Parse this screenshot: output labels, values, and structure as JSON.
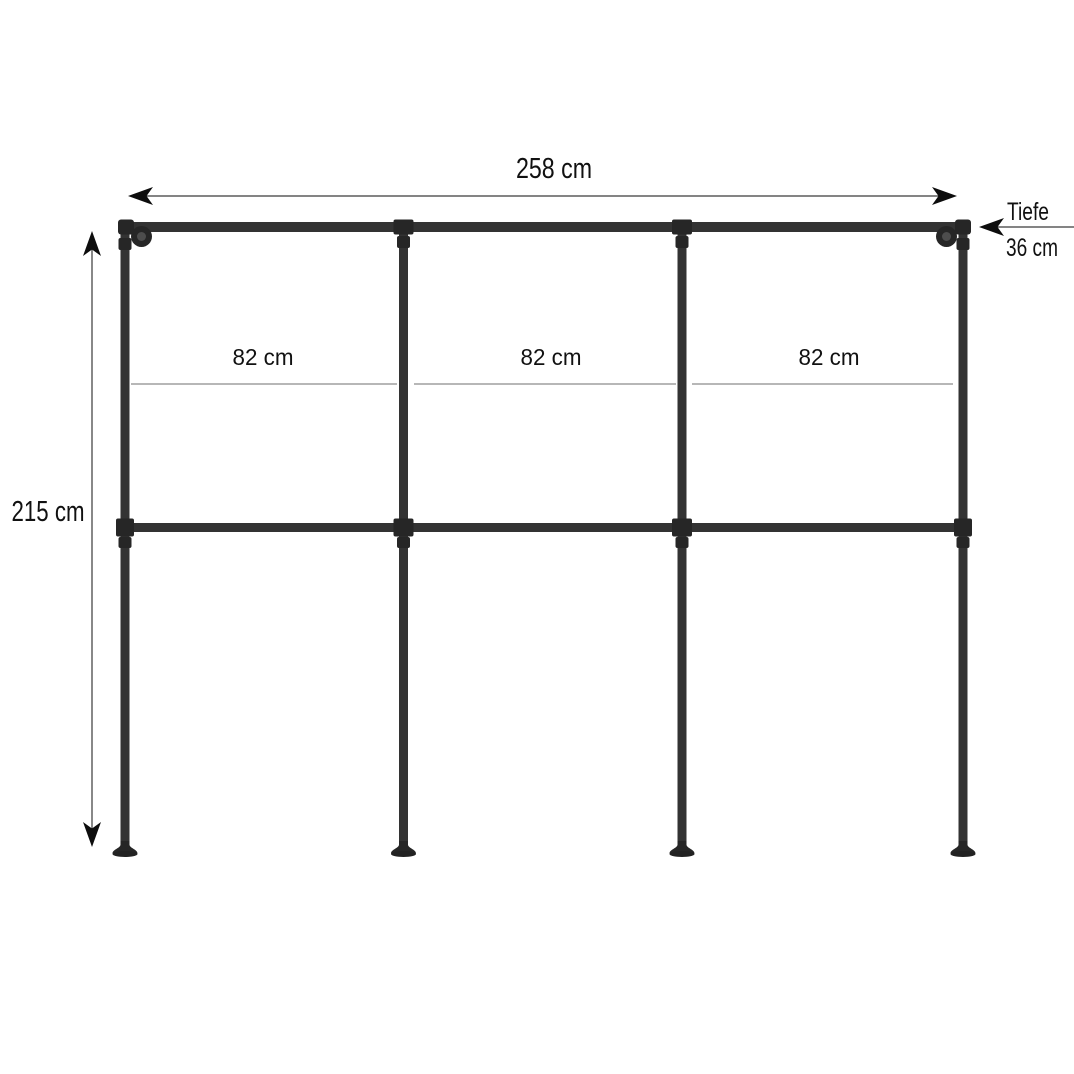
{
  "diagram": {
    "description": "Industrial pipe wardrobe rack dimension drawing, 3 sections, wall and floor mounted",
    "width_label": "258 cm",
    "height_label": "215 cm",
    "depth_title": "Tiefe",
    "depth_value": "36 cm",
    "sections": [
      {
        "label": "82 cm"
      },
      {
        "label": "82 cm"
      },
      {
        "label": "82 cm"
      }
    ]
  },
  "colors": {
    "background": "#ffffff",
    "pipe": "#333333",
    "pipe_dark": "#222222",
    "fitting": "#262626",
    "fitting_highlight": "#4d4d4d",
    "text": "#111111",
    "dimension_line": "#3a3a3a",
    "arrowhead": "#0d0d0d",
    "section_line": "#8c8c8c"
  }
}
